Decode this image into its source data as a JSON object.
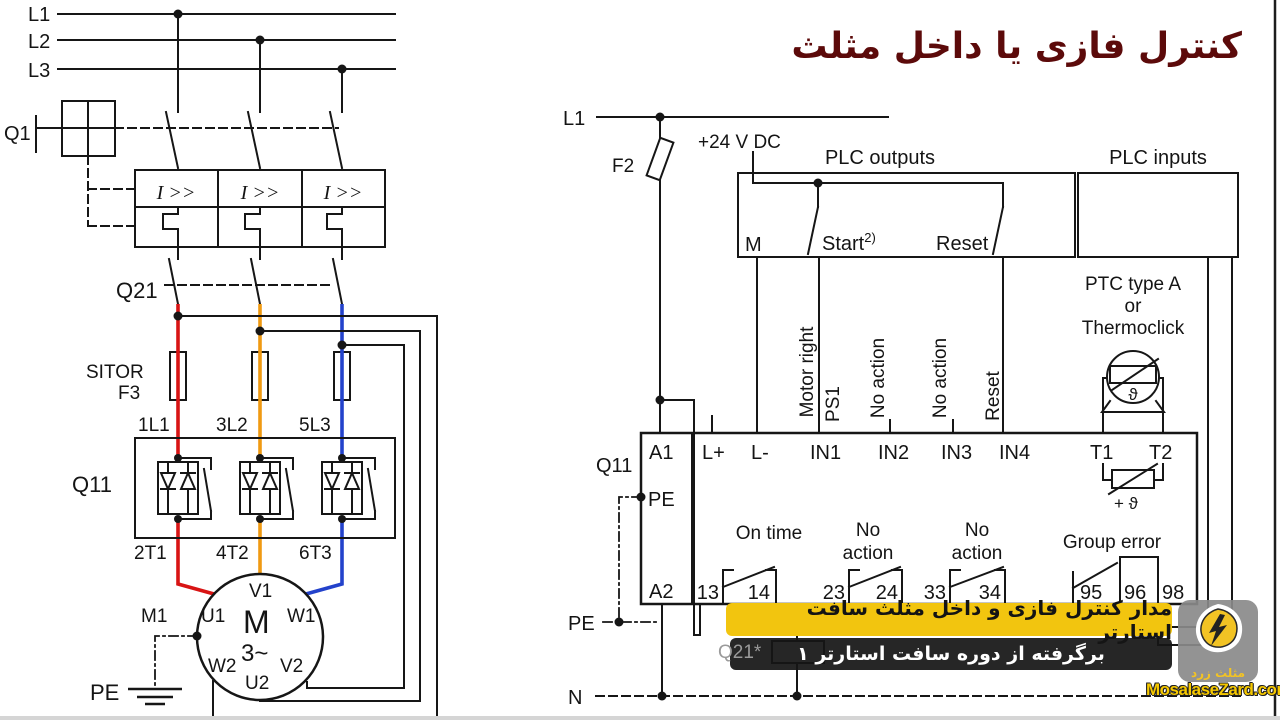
{
  "title": {
    "text": "کنترل فازی یا داخل مثلث",
    "color": "#5c0a0a"
  },
  "power": {
    "phases": {
      "l1": "L1",
      "l2": "L2",
      "l3": "L3"
    },
    "q1": "Q1",
    "overload": "I >>",
    "q21": "Q21",
    "sitor": "SITOR",
    "f3": "F3",
    "in_terms": {
      "t1": "1L1",
      "t2": "3L2",
      "t3": "5L3"
    },
    "q11": "Q11",
    "out_terms": {
      "t1": "2T1",
      "t2": "4T2",
      "t3": "6T3"
    },
    "motor": {
      "m1": "M1",
      "m": "M",
      "ph": "3~",
      "v1": "V1",
      "u1": "U1",
      "w1": "W1",
      "w2": "W2",
      "u2": "U2",
      "v2": "V2"
    },
    "pe": "PE",
    "wire_colors": {
      "l1": "#d81414",
      "l2": "#f09a12",
      "l3": "#2342cb"
    }
  },
  "control": {
    "l1": "L1",
    "f2": "F2",
    "supply": "+24 V DC",
    "plc_out": {
      "label": "PLC outputs",
      "m": "M",
      "start": "Start",
      "start_sup": "2)",
      "reset": "Reset"
    },
    "plc_in": {
      "label": "PLC inputs"
    },
    "funcs": {
      "motor_right": "Motor right",
      "ps1": "PS1",
      "no_action": "No action",
      "reset": "Reset"
    },
    "ptc": {
      "l1": "PTC type A",
      "l2": "or",
      "l3": "Thermoclick",
      "theta": "ϑ",
      "plus_theta": "+ ϑ"
    },
    "q11": "Q11",
    "dev": {
      "a1": "A1",
      "pe": "PE",
      "a2": "A2",
      "lp": "L+",
      "lm": "L-",
      "in1": "IN1",
      "in2": "IN2",
      "in3": "IN3",
      "in4": "IN4",
      "t1": "T1",
      "t2": "T2"
    },
    "outs": {
      "on_time": "On time",
      "no": "No",
      "action": "action",
      "group": "Group error",
      "n13": "13",
      "n14": "14",
      "n23": "23",
      "n24": "24",
      "n33": "33",
      "n34": "34",
      "n95": "95",
      "n96": "96",
      "n98": "98"
    },
    "q21_coil": "Q21*",
    "pe": "PE",
    "n": "N"
  },
  "banners": {
    "yellow": {
      "text": "مدار کنترل فازی و داخل مثلث سافت استارتر",
      "bg": "#f2c50f",
      "fg": "#141414"
    },
    "black": {
      "text": "برگرفته از دوره سافت استارتر ۱",
      "bg": "#161616",
      "fg": "#ffffff"
    }
  },
  "logo": {
    "fa": "مثلث زرد",
    "site": "MosalaseZard.com",
    "accent": "#f6c800"
  }
}
